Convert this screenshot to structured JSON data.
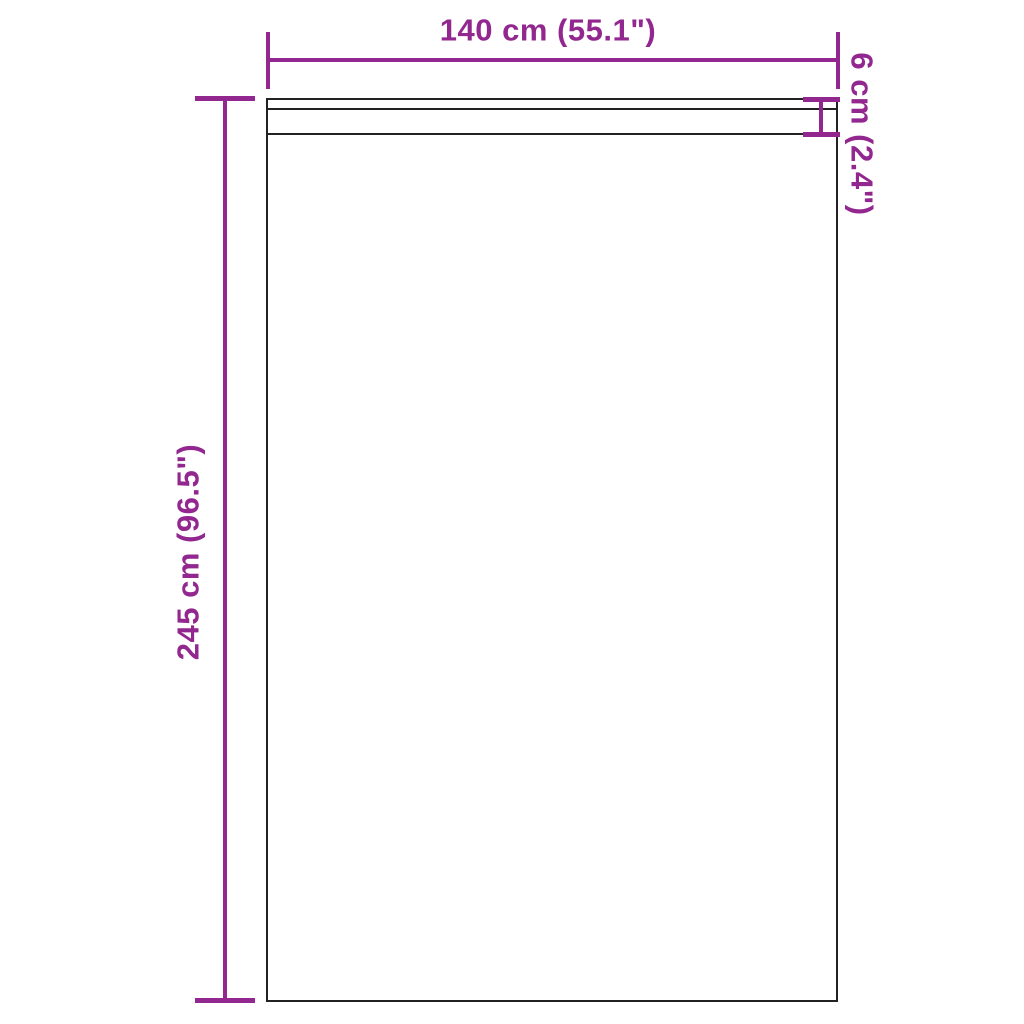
{
  "diagram": {
    "title": "Curtain panel dimension diagram",
    "colors": {
      "accent": "#92278F",
      "outline": "#222222",
      "background": "#FFFFFF"
    },
    "dimensions": {
      "width": {
        "label": "140 cm (55.1\")",
        "orientation": "horizontal",
        "position": "top"
      },
      "height": {
        "label": "245 cm (96.5\")",
        "orientation": "vertical",
        "position": "left"
      },
      "header_height": {
        "label": "6 cm (2.4\")",
        "orientation": "vertical",
        "position": "right"
      }
    }
  }
}
